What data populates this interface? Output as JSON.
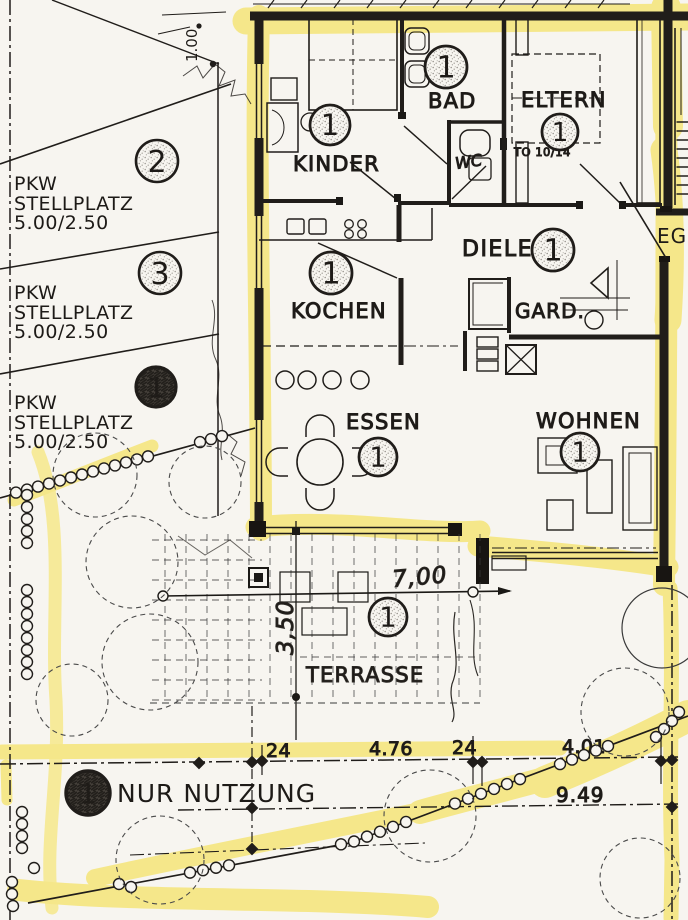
{
  "palette": {
    "paper": "#f7f5f0",
    "ink": "#201d1a",
    "highlighter": "#f4df4c"
  },
  "parking": {
    "stalls": [
      {
        "marker": "2",
        "label_lines": [
          "PKW",
          "STELLPLATZ",
          "5.00/2.50"
        ]
      },
      {
        "marker": "3",
        "label_lines": [
          "PKW",
          "STELLPLATZ",
          "5.00/2.50"
        ]
      },
      {
        "marker": "1",
        "label_lines": [
          "PKW",
          "STELLPLATZ",
          "5.00/2.50"
        ]
      }
    ]
  },
  "rooms": {
    "kinder": {
      "label": "KINDER",
      "marker": "1"
    },
    "bad": {
      "label": "BAD",
      "marker": "1"
    },
    "wc": {
      "label": "WC"
    },
    "eltern": {
      "label": "ELTERN",
      "marker": "1",
      "door_note": "TO 10/14"
    },
    "diele": {
      "label": "DIELE",
      "marker": "1"
    },
    "gard": {
      "label": "GARD."
    },
    "kochen": {
      "label": "KOCHEN",
      "marker": "1"
    },
    "essen": {
      "label": "ESSEN",
      "marker": "1"
    },
    "wohnen": {
      "label": "WOHNEN",
      "marker": "1"
    },
    "terrasse": {
      "label": "TERRASSE",
      "marker": "1"
    }
  },
  "annotations": {
    "floor_label": "EG.",
    "usage_note": "NUR NUTZUNG",
    "usage_marker": "1",
    "top_dimension": "1.00"
  },
  "dimensions": {
    "terrace_width": "7,00",
    "terrace_depth": "3,50",
    "chain": [
      "24",
      "4.76",
      "24",
      "4.01"
    ],
    "total": "9.49"
  }
}
